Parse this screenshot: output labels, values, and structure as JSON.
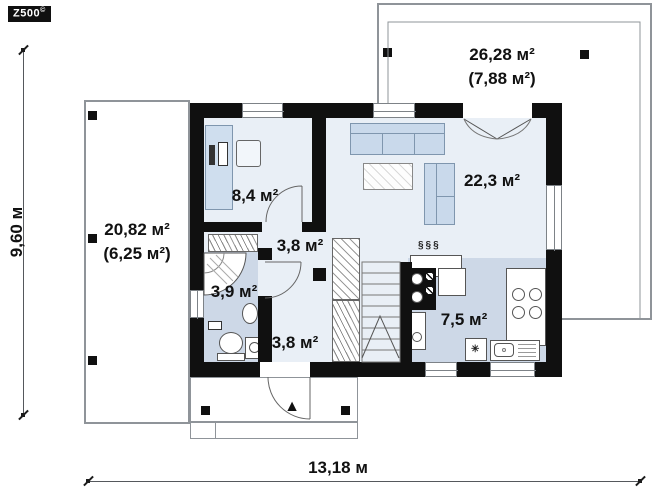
{
  "logo": {
    "brand": "Z500",
    "trademark": "©"
  },
  "dimensions": {
    "width": "13,18 м",
    "height": "9,60 м"
  },
  "rooms": {
    "terrace_left": {
      "area": "20,82 м²",
      "roofed_area": "(6,25 м²)"
    },
    "terrace_top": {
      "area": "26,28 м²",
      "roofed_area": "(7,88 м²)"
    },
    "office": {
      "area": "8,4 м²"
    },
    "hall_upper": {
      "area": "3,8 м²"
    },
    "bathroom": {
      "area": "3,9 м²"
    },
    "hall_entry": {
      "area": "3,8 м²"
    },
    "living_room": {
      "area": "22,3 м²"
    },
    "kitchen": {
      "area": "7,5 м²"
    }
  },
  "symbols": {
    "radiator": "§§§",
    "lamp": "✳",
    "entrance": "▲"
  },
  "colors": {
    "floor_light": "#e9eff6",
    "floor_dark": "#cdd8e7",
    "wall": "#101010",
    "furniture_fill": "#c9d9eb",
    "outline_gray": "#8f9499"
  }
}
